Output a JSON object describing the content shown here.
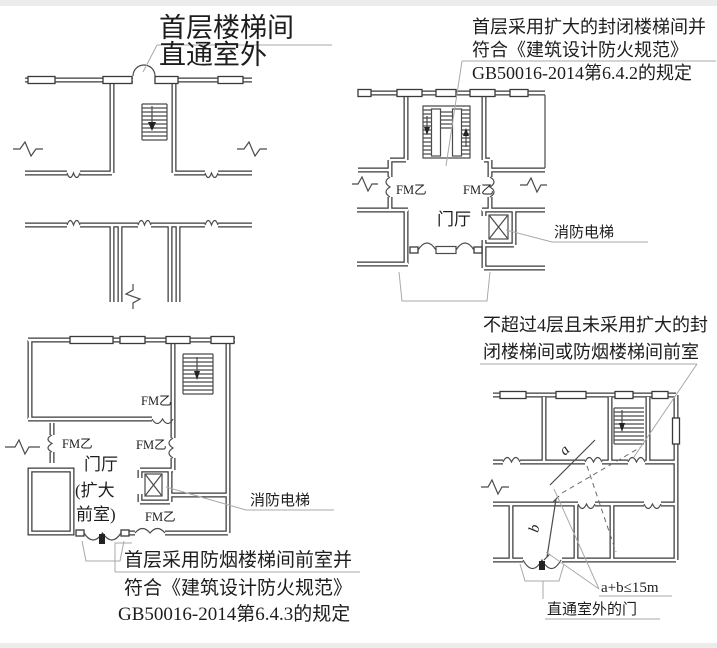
{
  "colors": {
    "ink": "#3a3a3a",
    "thin_line": "#4b4b4b",
    "leader": "#a9a9a9",
    "background": "#ffffff",
    "edge_band": "#ececec"
  },
  "labels": {
    "fire_door": "FM乙",
    "lobby": "门厅",
    "fire_elevator": "消防电梯"
  },
  "panels": {
    "top_left": {
      "title_line1": "首层楼梯间",
      "title_line2": "直通室外"
    },
    "top_right": {
      "note_line1": "首层采用扩大的封闭楼梯间并",
      "note_line2": "符合《建筑设计防火规范》",
      "note_line3": "GB50016-2014第6.4.2的规定"
    },
    "bottom_left": {
      "lobby_line1": "门厅",
      "lobby_line2": "(扩大",
      "lobby_line3": "前室)",
      "note_line1": "首层采用防烟楼梯间前室并",
      "note_line2": "符合《建筑设计防火规范》",
      "note_line3": "GB50016-2014第6.4.3的规定"
    },
    "bottom_right": {
      "note_line1": "不超过4层且未采用扩大的封",
      "note_line2": "闭楼梯间或防烟楼梯间前室",
      "dim_a": "a",
      "dim_b": "b",
      "formula": "a+b≤15m",
      "exit_label": "直通室外的门"
    }
  }
}
